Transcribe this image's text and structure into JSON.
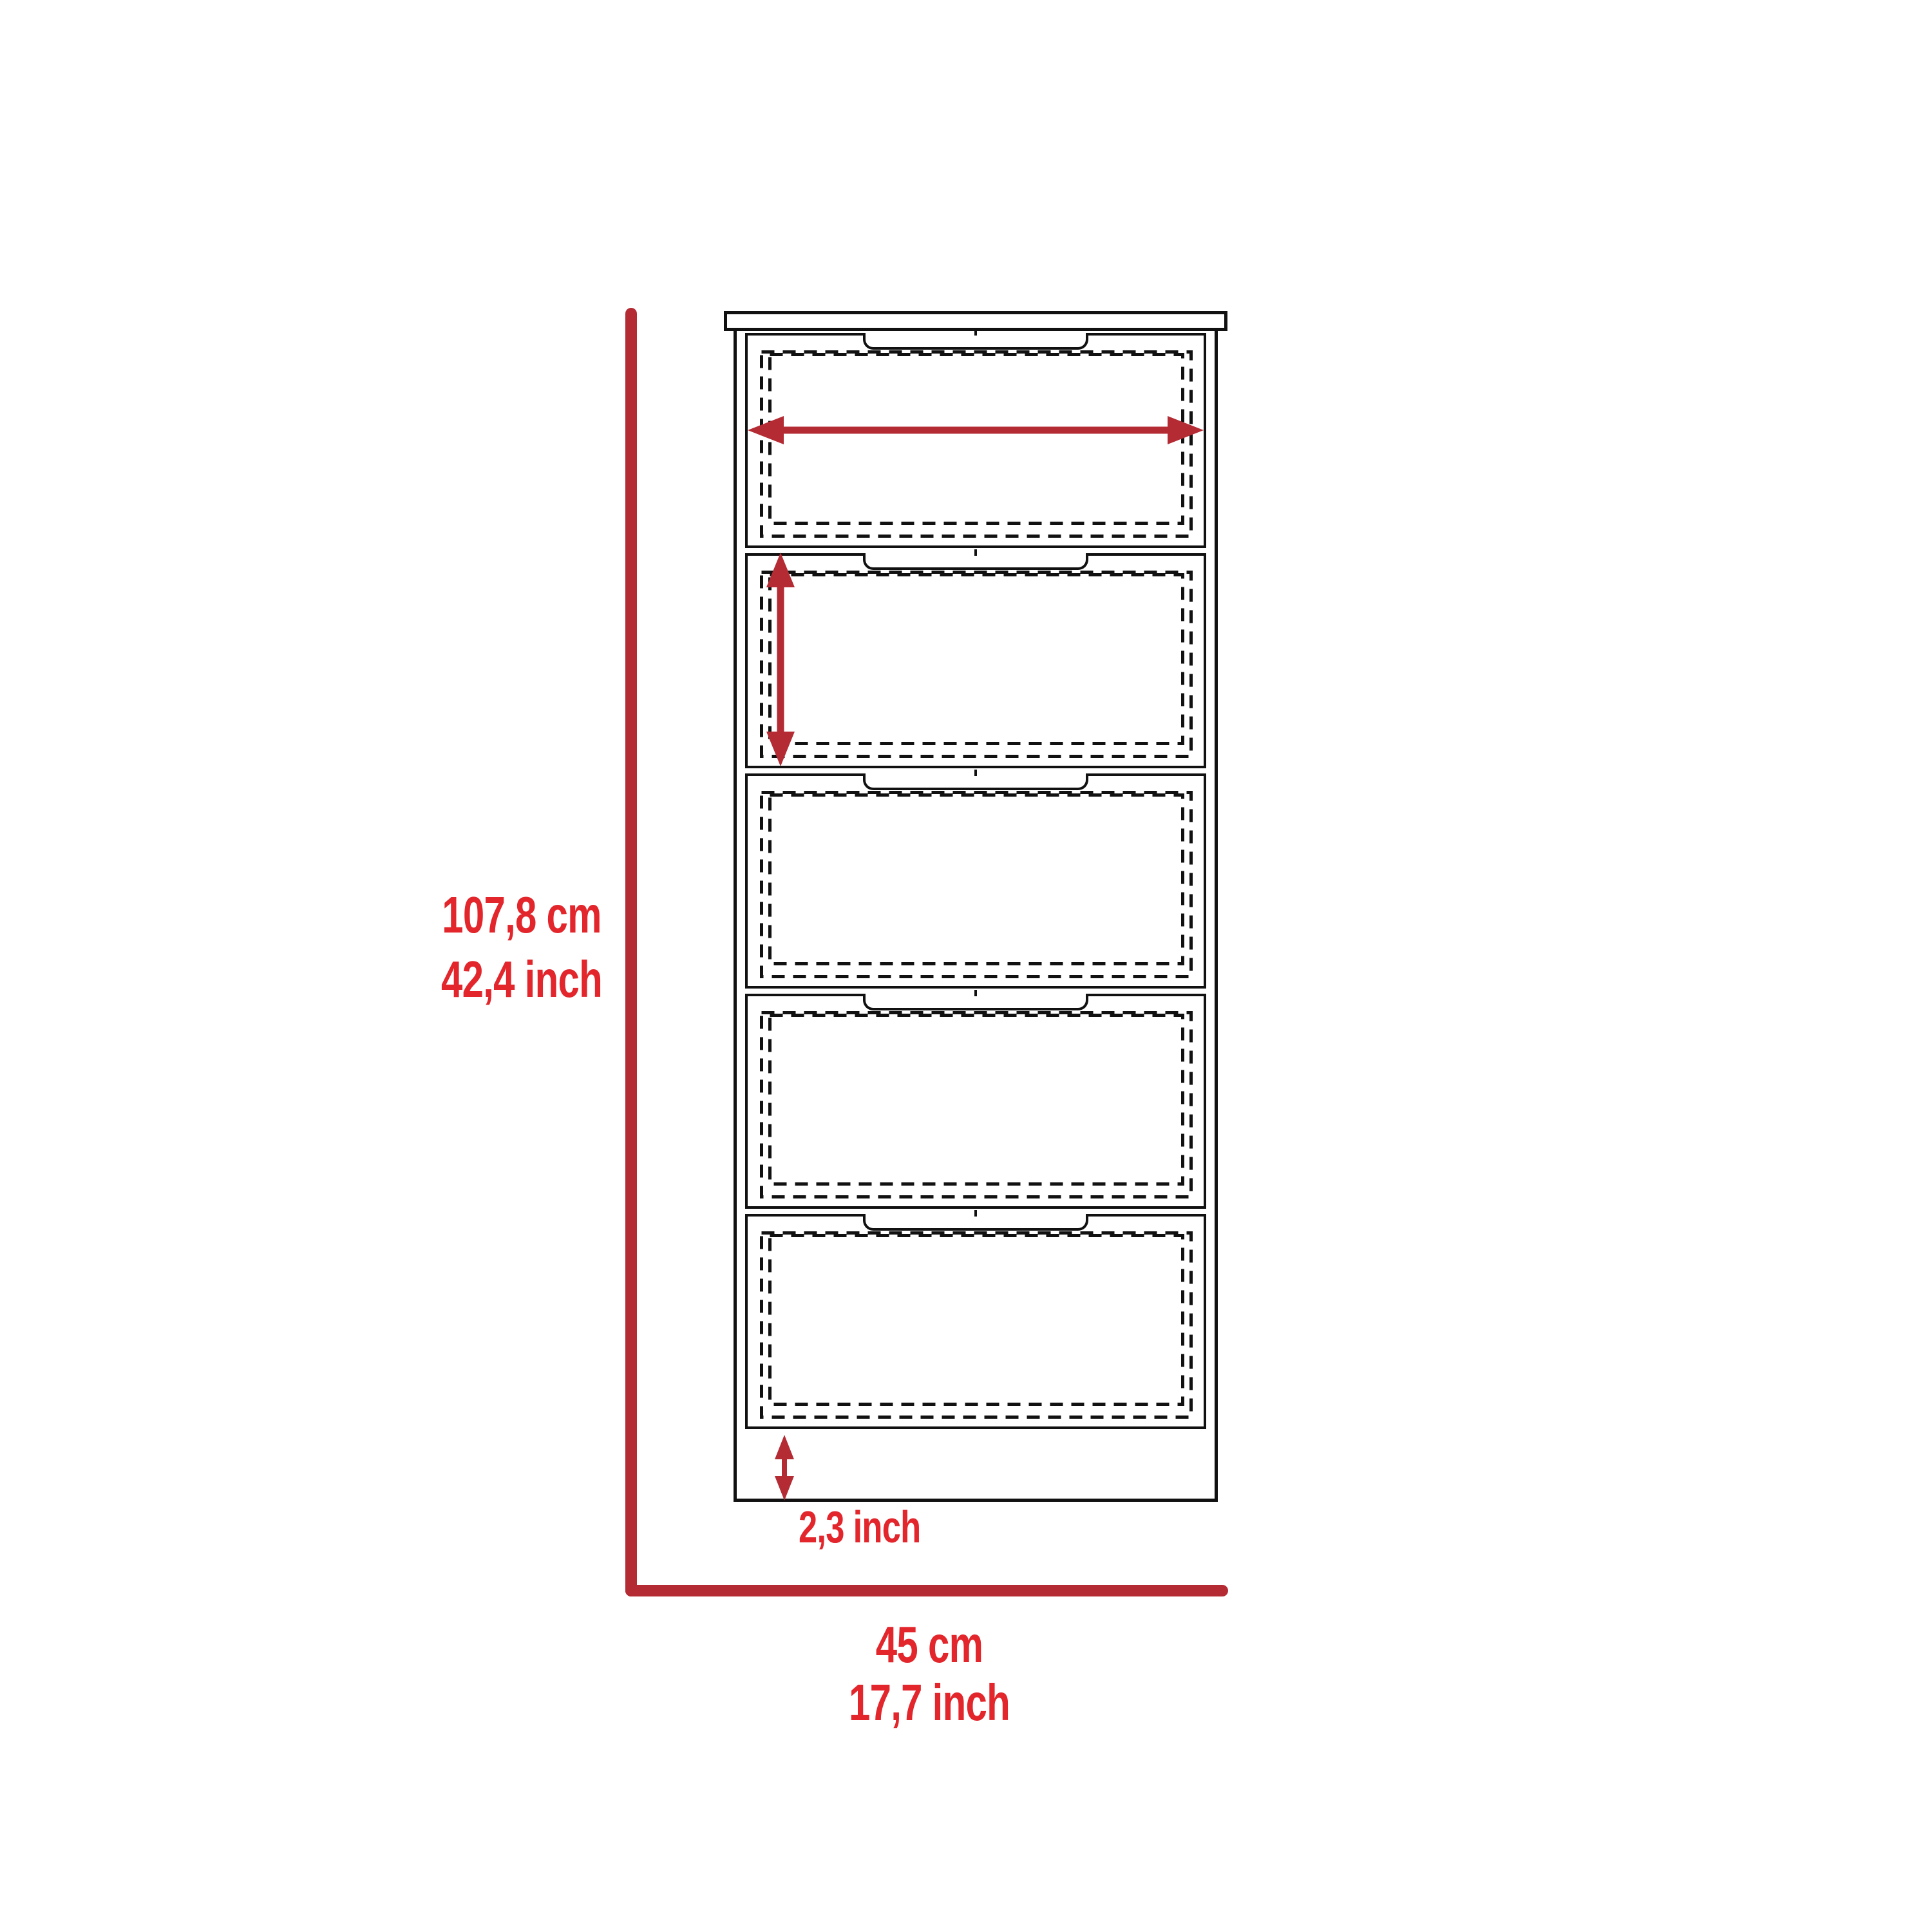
{
  "figure": {
    "description": "Dimension diagram of a tall 5-drawer dresser, front view, with red measurement annotations",
    "units": [
      "cm",
      "inch"
    ]
  },
  "colors": {
    "line_red": "#B42B34",
    "text_red": "#E2262C",
    "stroke_black": "#111111",
    "background": "#FFFFFF"
  },
  "dimensions": {
    "overall_height": {
      "cm": "107,8 cm",
      "inch": "42,4 inch"
    },
    "overall_width": {
      "cm": "45 cm",
      "inch": "17,7 inch"
    },
    "drawer_width": {
      "cm": "41,4 cm",
      "inch": "16,2 inch"
    },
    "drawer_height": {
      "cm": "19 cm",
      "inch": "7,2 inch"
    },
    "base_height": {
      "cm": "6 cm",
      "inch": "2,3 inch"
    }
  },
  "drawers": [
    {
      "name": "drawer-1"
    },
    {
      "name": "drawer-2"
    },
    {
      "name": "drawer-3"
    },
    {
      "name": "drawer-4"
    },
    {
      "name": "drawer-5"
    }
  ]
}
